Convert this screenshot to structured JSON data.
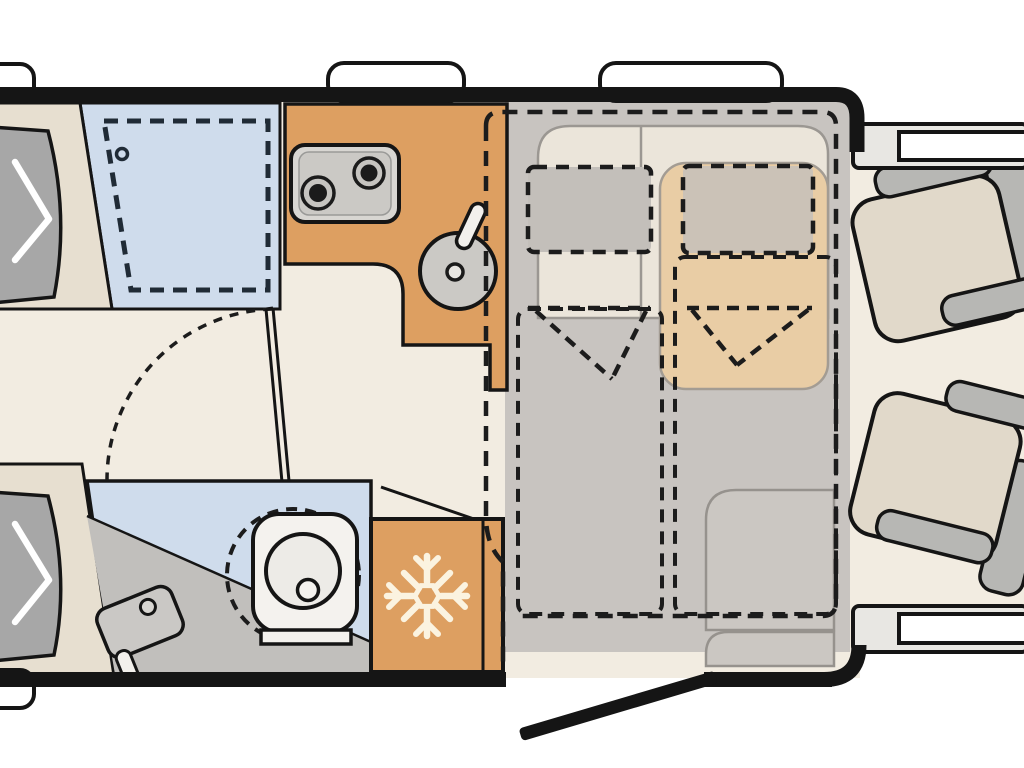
{
  "diagram": {
    "type": "motorhome-floorplan-top-view",
    "orientation": "rear-left-cab-right",
    "areas": {
      "rear_beds": "twin-single-beds",
      "shower": "shower-cubicle",
      "kitchen": "kitchen-block-with-hob-and-sink",
      "washroom": "washroom-with-toilet-and-basin",
      "refrigerator": "refrigerator",
      "dinette": "half-dinette-seating-group",
      "drop_down_bed": "pull-down-bed-outline",
      "cab": "swivel-cab-seats",
      "entry": "entry-door-open"
    },
    "icons": [
      {
        "name": "snowflake-icon",
        "meaning": "refrigerator"
      },
      {
        "name": "hob-burners-icon",
        "meaning": "two-ring gas hob"
      },
      {
        "name": "sink-icon",
        "meaning": "round kitchen sink"
      },
      {
        "name": "toilet-icon",
        "meaning": "swivel cassette toilet"
      },
      {
        "name": "pillow-arrow-icon",
        "meaning": "bed head end marker"
      }
    ]
  },
  "colors": {
    "background": "#ffffff",
    "wall": "#151515",
    "floor": "#f2ece1",
    "dinette_floor": "#c8c4c0",
    "platform": "#ebe5da",
    "platform_line": "#9b9792",
    "bed_beige": "#e7dfd0",
    "pillow_gray": "#a7a7a7",
    "shower_blue": "#cfdcec",
    "counter_orange": "#dd9f61",
    "appliance_gray": "#cbc9c5",
    "appliance_dark": "#1b1b1b",
    "bench_tan": "#e9cda5",
    "backrest_left": "#c3bfba",
    "backrest_right": "#cbc2b7",
    "washroom_gray": "#c1bfbc",
    "porcelain": "#f4f2ee",
    "snowflake": "#fbf3e0",
    "step_gray": "#cbc7c2",
    "step_line": "#96928d",
    "cab_seat": "#e1d9ca",
    "armrest": "#b7b7b4",
    "door_strip": "#e8e7e3",
    "window_white": "#ffffff"
  }
}
